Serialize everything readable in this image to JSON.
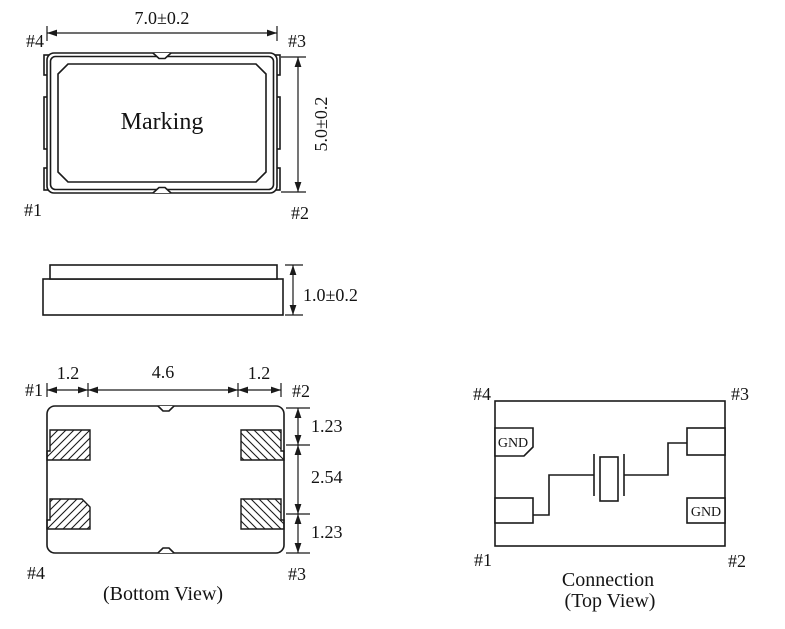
{
  "colors": {
    "line": "#1a1a1a",
    "background": "#ffffff"
  },
  "top_view": {
    "marking_label": "Marking",
    "width_dimension": "7.0±0.2",
    "height_dimension": "5.0±0.2",
    "pin_top_left": "#4",
    "pin_top_right": "#3",
    "pin_bottom_left": "#1",
    "pin_bottom_right": "#2"
  },
  "side_view": {
    "thickness_dimension": "1.0±0.2"
  },
  "bottom_view": {
    "caption": "(Bottom View)",
    "horizontal_dims": [
      "1.2",
      "4.6",
      "1.2"
    ],
    "vertical_dims": [
      "1.23",
      "2.54",
      "1.23"
    ],
    "pin_top_left": "#1",
    "pin_top_right": "#2",
    "pin_bottom_left": "#4",
    "pin_bottom_right": "#3"
  },
  "connection_view": {
    "caption_line1": "Connection",
    "caption_line2": "(Top View)",
    "gnd_label_pin4": "GND",
    "gnd_label_pin2": "GND",
    "pin_top_left": "#4",
    "pin_top_right": "#3",
    "pin_bottom_left": "#1",
    "pin_bottom_right": "#2"
  }
}
